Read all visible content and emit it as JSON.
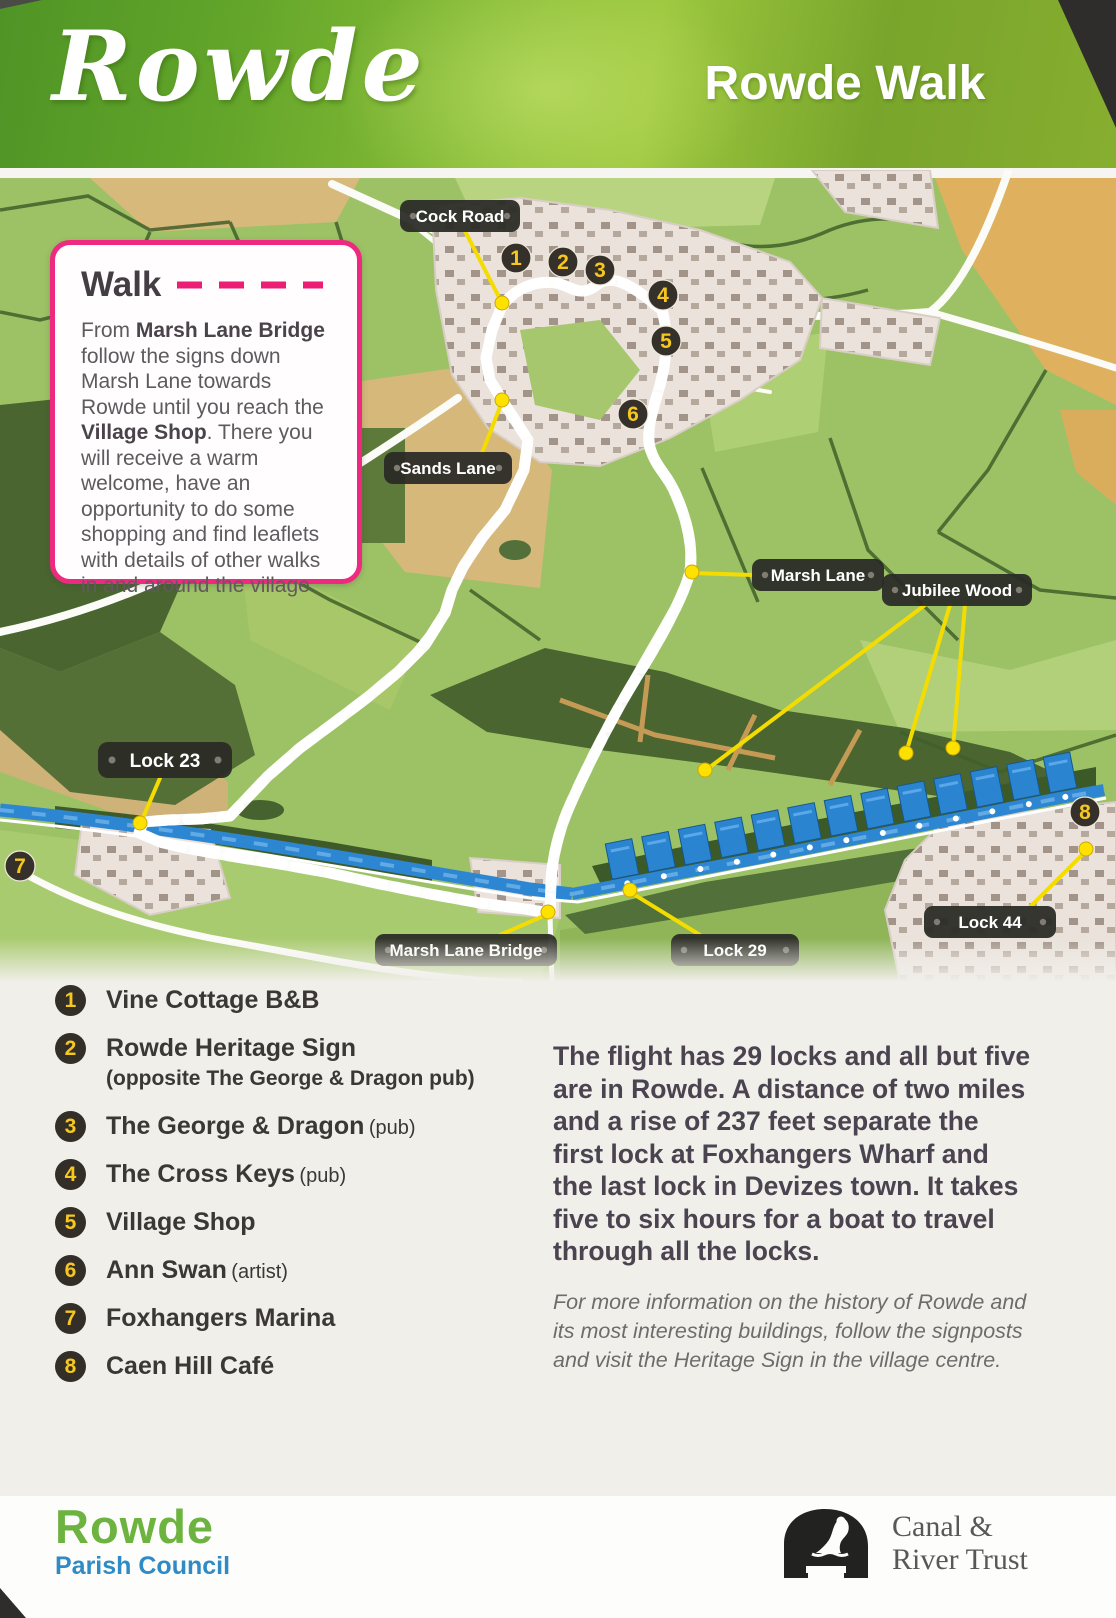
{
  "header": {
    "logo": "Rowde",
    "title": "Rowde Walk"
  },
  "walk": {
    "title": "Walk",
    "seg1": "From ",
    "b1": "Marsh Lane Bridge",
    "seg2": " follow the signs down Marsh Lane towards Rowde until you reach the ",
    "b2": "Village Shop",
    "seg3": ". There you will receive a warm welcome, have an opportunity to do some shopping and find leaflets with details of other walks in and around the village."
  },
  "map": {
    "labels": {
      "cock_road": "Cock Road",
      "sands_lane": "Sands Lane",
      "marsh_lane": "Marsh Lane",
      "jubilee_wood": "Jubilee Wood",
      "lock_23": "Lock 23",
      "lock_29": "Lock 29",
      "lock_44": "Lock 44",
      "marsh_lane_bridge": "Marsh Lane Bridge"
    },
    "markers": [
      "1",
      "2",
      "3",
      "4",
      "5",
      "6",
      "7",
      "8"
    ],
    "colors": {
      "route_pink": "#ec1d75",
      "leader_yellow": "#f4dc00",
      "canal_blue": "#2d86d2",
      "label_dark": "#2b2a26"
    }
  },
  "legend": {
    "items": [
      {
        "num": "1",
        "name": "Vine Cottage B&B",
        "suffix": "",
        "note": ""
      },
      {
        "num": "2",
        "name": "Rowde Heritage Sign",
        "suffix": "",
        "note": "(opposite The George & Dragon pub)"
      },
      {
        "num": "3",
        "name": "The George & Dragon",
        "suffix": "(pub)",
        "note": ""
      },
      {
        "num": "4",
        "name": "The Cross Keys",
        "suffix": "(pub)",
        "note": ""
      },
      {
        "num": "5",
        "name": "Village Shop",
        "suffix": "",
        "note": ""
      },
      {
        "num": "6",
        "name": "Ann Swan",
        "suffix": "(artist)",
        "note": ""
      },
      {
        "num": "7",
        "name": "Foxhangers Marina",
        "suffix": "",
        "note": ""
      },
      {
        "num": "8",
        "name": "Caen Hill Café",
        "suffix": "",
        "note": ""
      }
    ]
  },
  "info": {
    "paragraph": "The flight has 29 locks and all but five are in Rowde. A distance of two miles and a rise of 237 feet separate the first lock at Foxhangers Wharf and the last lock in Devizes town. It takes five to six hours for a boat to travel through all the locks.",
    "note": "For more information on the history of Rowde and its most interesting buildings, follow the signposts and visit the Heritage Sign in the village centre."
  },
  "footer": {
    "council_name": "Rowde",
    "council_sub": "Parish Council",
    "trust_line1": "Canal &",
    "trust_line2": "River Trust"
  }
}
